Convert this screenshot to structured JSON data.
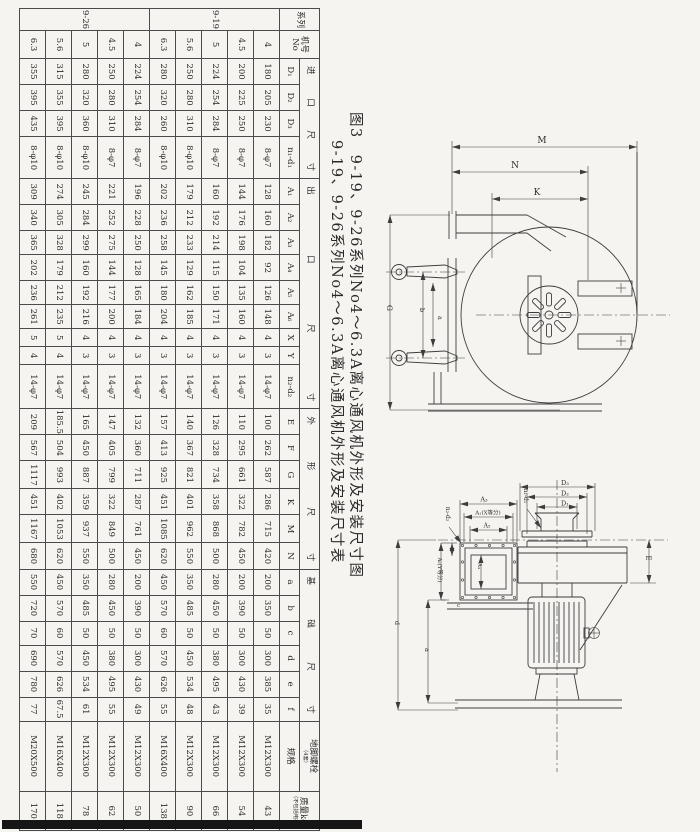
{
  "titles": {
    "line1": "图3　9-19、9-26系列No4～6.3A离心通风机外形及安装尺寸图",
    "line2": "9-19、9-26系列No4～6.3A离心通风机外形及安装尺寸表"
  },
  "table": {
    "groups": [
      {
        "label": "系列"
      },
      {
        "label": "机号\nNo"
      },
      {
        "label": "进口尺寸",
        "cols": [
          "D₁",
          "D₂",
          "D₃",
          "n₁-d₁"
        ]
      },
      {
        "label": "出口尺寸",
        "cols": [
          "A₁",
          "A₂",
          "A₃",
          "A₄",
          "A₅",
          "A₆",
          "X",
          "Y",
          "n₂-d₂"
        ]
      },
      {
        "label": "外形尺寸",
        "cols": [
          "E",
          "F",
          "G",
          "K",
          "M",
          "N"
        ]
      },
      {
        "label": "基础尺寸",
        "cols": [
          "a",
          "b",
          "c",
          "d",
          "e",
          "f"
        ]
      },
      {
        "label": "地脚螺栓",
        "note": "（4套）",
        "cols": [
          "规格"
        ]
      },
      {
        "label": "质量kg",
        "note": "（不包括电机）"
      }
    ],
    "series": [
      {
        "name": "9-19",
        "rows": [
          [
            "4",
            "180",
            "205",
            "230",
            "8-φ7",
            "128",
            "160",
            "182",
            "92",
            "126",
            "148",
            "4",
            "3",
            "14-φ7",
            "100",
            "262",
            "587",
            "286",
            "715",
            "420",
            "200",
            "350",
            "50",
            "300",
            "385",
            "35",
            "M12X300",
            "43"
          ],
          [
            "4.5",
            "200",
            "225",
            "250",
            "8-φ7",
            "144",
            "176",
            "198",
            "104",
            "135",
            "160",
            "4",
            "3",
            "14-φ7",
            "110",
            "295",
            "661",
            "322",
            "782",
            "450",
            "200",
            "390",
            "50",
            "300",
            "430",
            "39",
            "M12X300",
            "54"
          ],
          [
            "5",
            "224",
            "254",
            "284",
            "8-φ7",
            "160",
            "192",
            "214",
            "115",
            "150",
            "171",
            "4",
            "3",
            "14-φ7",
            "126",
            "328",
            "734",
            "358",
            "868",
            "500",
            "280",
            "450",
            "50",
            "380",
            "495",
            "43",
            "M12X300",
            "66"
          ],
          [
            "5.6",
            "250",
            "280",
            "310",
            "8-φ10",
            "179",
            "212",
            "233",
            "129",
            "162",
            "185",
            "4",
            "3",
            "14-φ7",
            "140",
            "367",
            "821",
            "401",
            "962",
            "550",
            "350",
            "485",
            "50",
            "450",
            "534",
            "48",
            "M12X300",
            "90"
          ],
          [
            "6.3",
            "280",
            "320",
            "260",
            "8-φ10",
            "202",
            "236",
            "258",
            "145",
            "180",
            "204",
            "4",
            "3",
            "14-φ7",
            "157",
            "413",
            "925",
            "451",
            "1085",
            "620",
            "450",
            "570",
            "60",
            "570",
            "626",
            "55",
            "M16X400",
            "138"
          ]
        ]
      },
      {
        "name": "9-26",
        "rows": [
          [
            "4",
            "224",
            "254",
            "284",
            "8-φ7",
            "196",
            "228",
            "250",
            "128",
            "165",
            "184",
            "4",
            "3",
            "14-φ7",
            "132",
            "360",
            "711",
            "287",
            "761",
            "450",
            "200",
            "390",
            "50",
            "300",
            "430",
            "49",
            "M12X300",
            "50"
          ],
          [
            "4.5",
            "250",
            "280",
            "310",
            "8-φ7",
            "221",
            "252",
            "275",
            "144",
            "177",
            "200",
            "4",
            "3",
            "14-φ7",
            "147",
            "405",
            "799",
            "322",
            "849",
            "500",
            "280",
            "450",
            "50",
            "380",
            "495",
            "55",
            "M12X300",
            "62"
          ],
          [
            "5",
            "280",
            "320",
            "360",
            "8-φ10",
            "245",
            "284",
            "299",
            "160",
            "192",
            "216",
            "4",
            "3",
            "14-φ7",
            "165",
            "450",
            "887",
            "359",
            "937",
            "550",
            "350",
            "485",
            "50",
            "450",
            "534",
            "61",
            "M12X300",
            "78"
          ],
          [
            "5.6",
            "315",
            "355",
            "395",
            "8-φ10",
            "274",
            "305",
            "328",
            "179",
            "212",
            "235",
            "5",
            "4",
            "14-φ7",
            "185.5",
            "504",
            "993",
            "402",
            "1053",
            "620",
            "450",
            "570",
            "60",
            "570",
            "626",
            "67.5",
            "M16X400",
            "118"
          ],
          [
            "6.3",
            "355",
            "395",
            "435",
            "8-φ10",
            "309",
            "340",
            "365",
            "202",
            "236",
            "261",
            "5",
            "4",
            "14-φ7",
            "209",
            "567",
            "1117",
            "451",
            "1167",
            "680",
            "550",
            "720",
            "70",
            "690",
            "780",
            "77",
            "M20X500",
            "170"
          ]
        ]
      }
    ]
  },
  "diagram": {
    "side": {
      "M": "M",
      "N": "N",
      "K": "K",
      "G": "G",
      "b": "b",
      "a": "a"
    },
    "front": {
      "D1": "D₁",
      "D2": "D₂",
      "D3": "D₃",
      "n1d1": "n₁-d₁",
      "A3": "A₃",
      "A1X": "A₁(X等分)",
      "A5": "A₅",
      "n2d2": "n₂-d₂",
      "A6Y": "A₆(Y等分)",
      "A4": "A₄",
      "f": "f",
      "c": "c",
      "a": "a",
      "d": "d",
      "E": "E"
    }
  }
}
